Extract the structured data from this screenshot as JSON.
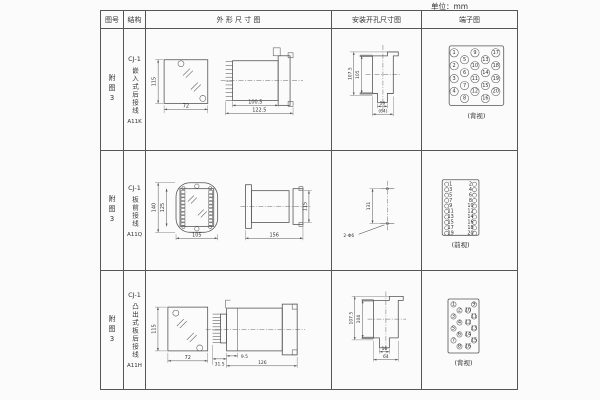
{
  "unit_label": "单位：mm",
  "header": {
    "fig_no": "图号",
    "structure": "结构",
    "outline": "外 形 尺 寸 图",
    "install": "安装开孔尺寸图",
    "terminal": "端子图"
  },
  "rows": [
    {
      "fig": "附图3",
      "model": "CJ-1",
      "structure": "嵌入式后接线",
      "code": "A11K",
      "outline_dims": {
        "front_height": "115",
        "front_width": "72",
        "depth_inner": "100.5",
        "depth_total": "122.5"
      },
      "install_dims": {
        "outer_height": "107.5",
        "inner_height": "105",
        "slot_width": "16",
        "total_width": "(64)"
      },
      "terminal": {
        "view_label": "(背视)",
        "numbers": [
          "1",
          "2",
          "3",
          "4",
          "5",
          "6",
          "7",
          "8",
          "9",
          "10",
          "11",
          "12",
          "13",
          "14",
          "15",
          "16",
          "17",
          "18",
          "19",
          "20"
        ]
      }
    },
    {
      "fig": "附图3",
      "model": "CJ-1",
      "structure": "板前接线",
      "code": "A11Q",
      "outline_dims": {
        "front_outer_height": "140",
        "front_inner_height": "125",
        "front_width": "105",
        "side_length": "156",
        "side_height": "115"
      },
      "install_dims": {
        "hole_spacing": "131",
        "holes_label": "2-Φ6"
      },
      "terminal": {
        "view_label": "(前视)",
        "left_numbers": [
          "1",
          "3",
          "5",
          "7",
          "9",
          "11",
          "13",
          "15",
          "17",
          "19"
        ],
        "right_numbers": [
          "2",
          "4",
          "6",
          "8",
          "10",
          "12",
          "14",
          "16",
          "18",
          "20"
        ]
      }
    },
    {
      "fig": "附图3",
      "model": "CJ-1",
      "structure": "凸出式板后接线",
      "code": "A11H",
      "outline_dims": {
        "front_height": "115",
        "front_width": "72",
        "fin_section": "31.5",
        "body_offset": "9.5",
        "body_length": "126"
      },
      "install_dims": {
        "outer_height": "107.5",
        "inner_height": "104",
        "slot_width": "16",
        "total_width": "64"
      },
      "terminal": {
        "view_label": "(背视)",
        "numbers": [
          "1",
          "2",
          "3",
          "4",
          "5",
          "6",
          "7",
          "8",
          "9",
          "10",
          "11",
          "12",
          "13",
          "14",
          "15",
          "16"
        ]
      }
    }
  ]
}
